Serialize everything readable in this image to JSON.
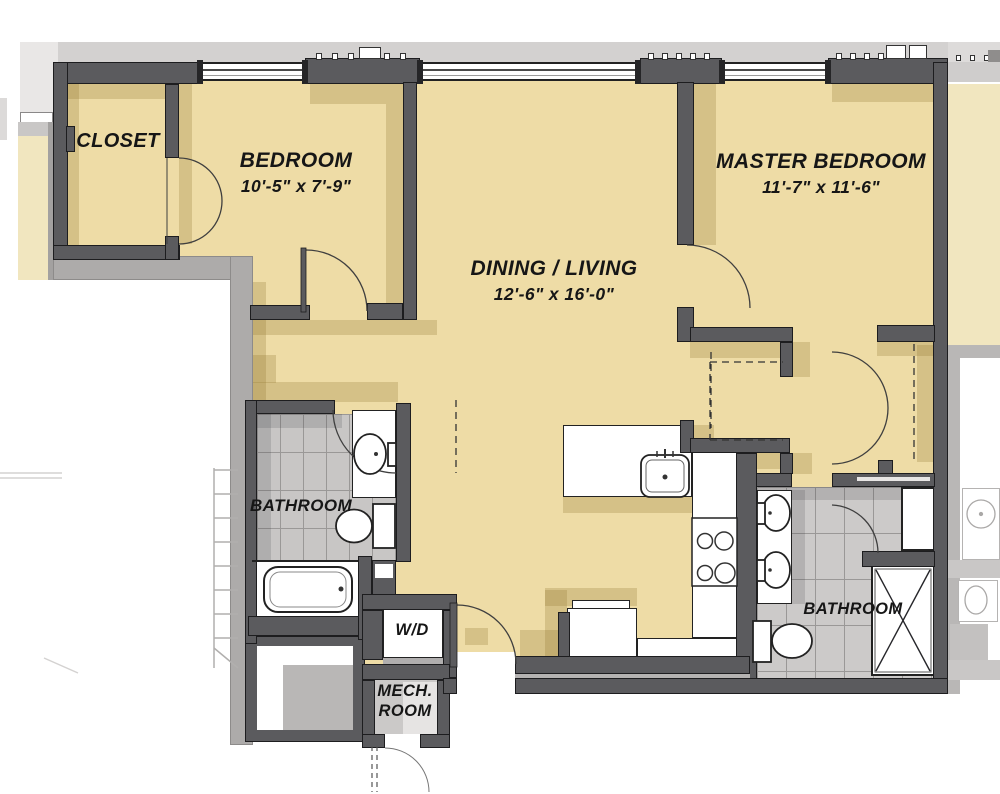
{
  "plan": {
    "type": "apartment-floor-plan",
    "rooms": [
      {
        "id": "closet",
        "label": "CLOSET"
      },
      {
        "id": "bedroom",
        "label": "BEDROOM",
        "dimensions": "10'-5\" x 7'-9\""
      },
      {
        "id": "dining_living",
        "label": "DINING / LIVING",
        "dimensions": "12'-6\" x 16'-0\""
      },
      {
        "id": "master_bedroom",
        "label": "MASTER BEDROOM",
        "dimensions": "11'-7\" x 11'-6\""
      },
      {
        "id": "bathroom_left",
        "label": "BATHROOM"
      },
      {
        "id": "bathroom_right",
        "label": "BATHROOM"
      },
      {
        "id": "laundry",
        "label": "W/D"
      },
      {
        "id": "mech_room",
        "label": "MECH.",
        "label2": "ROOM"
      }
    ],
    "fixtures": [
      "bathtub",
      "toilet",
      "vanity-sink",
      "double-vanity-sinks",
      "shower",
      "kitchen-island-sink",
      "range-cooktop",
      "refrigerator",
      "washer-dryer",
      "stairs",
      "closet-rod-dashed",
      "entry-door",
      "window-band"
    ]
  },
  "colors": {
    "floor": "#eedca6",
    "wall": "#5b5b5e",
    "tile": "#c8c6c5",
    "shadow": "rgba(148,121,52,0.27)",
    "context": "#d3d1d0",
    "adjacent_floor": "#f1e6bf",
    "void_border": "#adabaa"
  }
}
